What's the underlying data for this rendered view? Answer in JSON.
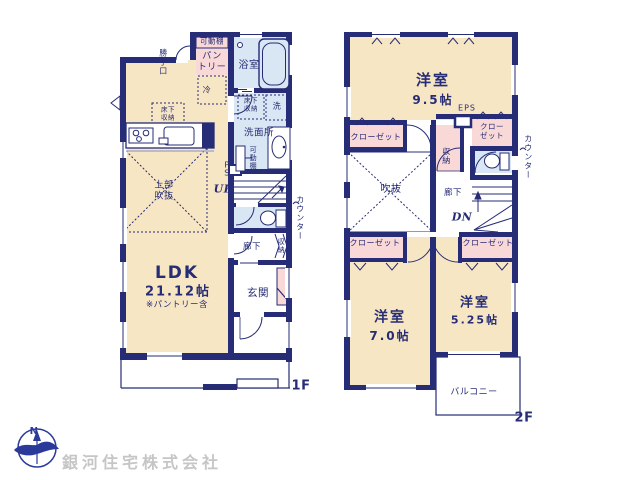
{
  "floor1": {
    "floor_label": "1F",
    "ldk_name": "LDK",
    "ldk_area": "21.12帖",
    "ldk_note": "※パントリー含",
    "upper_void": "上部\n吹抜",
    "pantry": "パン\nトリー",
    "pantry_shelf": "可動棚",
    "back_door": "勝手口",
    "bathroom": "浴室",
    "refrigerator": "冷",
    "underfloor_storage": "床下\n収納",
    "washer": "洗",
    "underfloor_storage2": "床下\n収納",
    "washroom": "洗面所",
    "movable_shelf": "可動棚",
    "pipe_space": "P\nS",
    "stairs_up": "UP",
    "counter": "カウンター",
    "hallway": "廊下",
    "storage": "収納",
    "entrance": "玄関"
  },
  "floor2": {
    "floor_label": "2F",
    "room1_name": "洋室",
    "room1_area": "9.5帖",
    "eps": "EPS",
    "closet_top_left": "クローゼット",
    "closet_top_right": "クロー\nゼット",
    "storage": "収納",
    "counter": "カウンター",
    "void": "吹抜",
    "hallway": "廊下",
    "stairs_down": "DN",
    "closet_bottom_left": "クローゼット",
    "closet_bottom_right": "クローゼット",
    "room2_name": "洋室",
    "room2_area": "7.0帖",
    "room3_name": "洋室",
    "room3_area": "5.25帖",
    "balcony": "バルコニー"
  },
  "footer": {
    "company": "銀河住宅株式会社",
    "compass_north": "N"
  },
  "colors": {
    "wall_navy": "#262c75",
    "room_cream": "#f7e6c3",
    "closet_pink": "#f9d8d8",
    "wet_blue": "#d9e6f3",
    "company_gray": "#c6c6c6"
  }
}
